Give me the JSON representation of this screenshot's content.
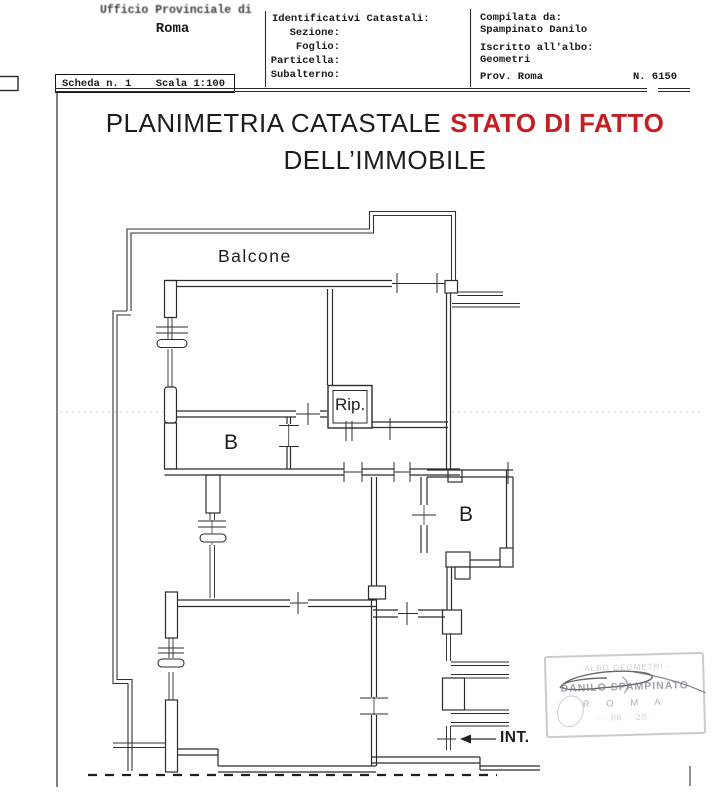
{
  "page": {
    "bg": "#ffffff",
    "ink": "#1f1f1f",
    "accent_red": "#c41e25"
  },
  "header": {
    "office": {
      "line1": "Ufficio Provinciale di",
      "line2": "Roma"
    },
    "catastali": {
      "title": "Identificativi Catastali:",
      "fields": [
        "Sezione:",
        "Foglio:",
        "Particella:",
        "Subalterno:"
      ]
    },
    "compiler": {
      "l1": "Compilata da:",
      "v1": "Spampinato Danilo",
      "l2": "Iscritto all'albo:",
      "v2": "Geometri",
      "l3": "Prov. Roma",
      "num": "N. 6150"
    },
    "scheda": {
      "left": "Scheda n. 1",
      "right": "Scala 1:100"
    }
  },
  "title": {
    "black": "PLANIMETRIA CATASTALE",
    "red": "STATO DI FATTO",
    "line2": "DELL’IMMOBILE"
  },
  "plan_labels": {
    "balcone": "Balcone",
    "rip": "Rip.",
    "bath_left": "B",
    "bath_right": "B",
    "int": "INT."
  },
  "stamp": {
    "top": "· ALBO GEOMETRI ·",
    "name": "DANILO SPAMPINATO",
    "city": "R O M A",
    "bottom": "··· 06 ·· 20··"
  }
}
